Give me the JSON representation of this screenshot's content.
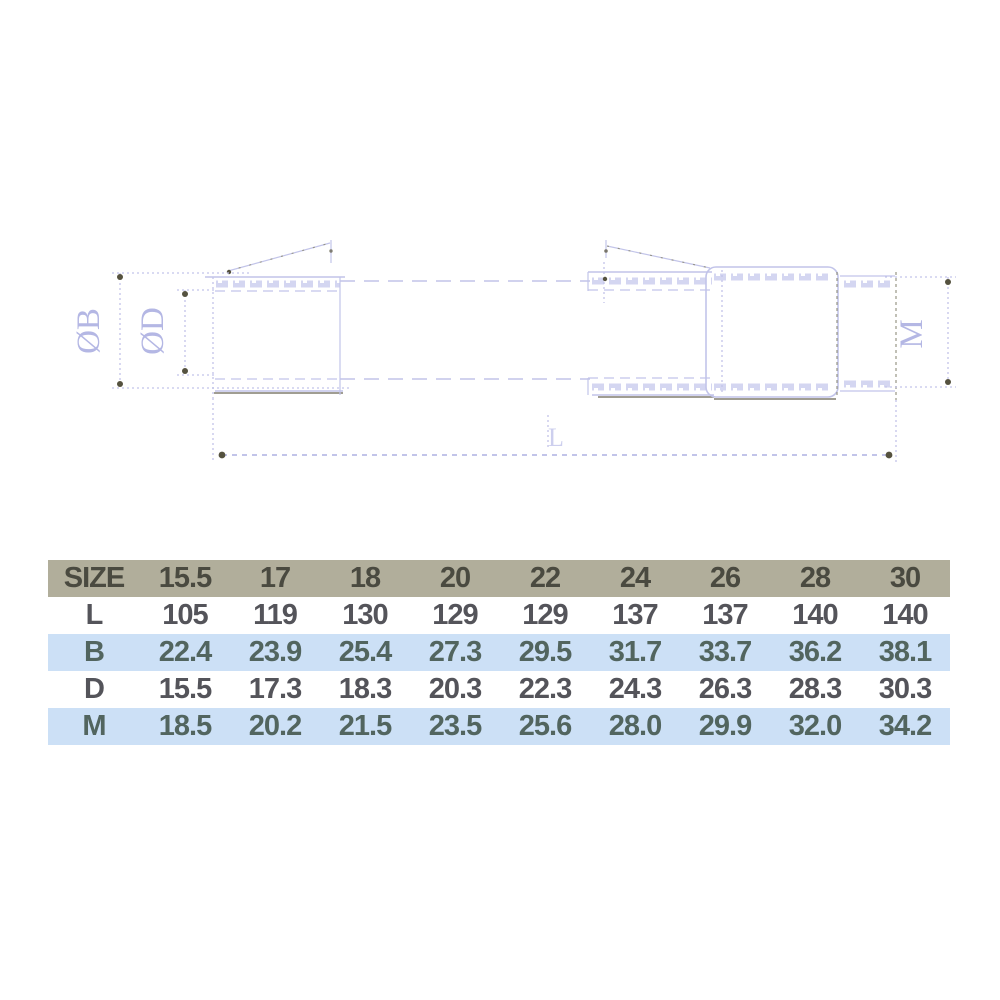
{
  "drawing": {
    "labels": {
      "diameter_b": "ØB",
      "diameter_d": "ØD",
      "length": "L",
      "thread": "M"
    },
    "colors": {
      "line": "#c2c4e9",
      "line_soft": "#cdcfee",
      "label": "#b4b7e4",
      "accent_dark": "#55523f",
      "accent_mid": "#8f8d7c"
    }
  },
  "table": {
    "colors": {
      "header_bg": "#b1ae9b",
      "stripe_bg": "#cce0f6",
      "plain_bg": "#ffffff",
      "header_text": "#4a4a40",
      "plain_text": "#54545a",
      "stripe_text": "#52655f"
    },
    "columns": [
      "SIZE",
      "15.5",
      "17",
      "18",
      "20",
      "22",
      "24",
      "26",
      "28",
      "30"
    ],
    "rows": [
      {
        "label": "L",
        "striped": false,
        "values": [
          "105",
          "119",
          "130",
          "129",
          "129",
          "137",
          "137",
          "140",
          "140"
        ]
      },
      {
        "label": "B",
        "striped": true,
        "values": [
          "22.4",
          "23.9",
          "25.4",
          "27.3",
          "29.5",
          "31.7",
          "33.7",
          "36.2",
          "38.1"
        ]
      },
      {
        "label": "D",
        "striped": false,
        "values": [
          "15.5",
          "17.3",
          "18.3",
          "20.3",
          "22.3",
          "24.3",
          "26.3",
          "28.3",
          "30.3"
        ]
      },
      {
        "label": "M",
        "striped": true,
        "values": [
          "18.5",
          "20.2",
          "21.5",
          "23.5",
          "25.6",
          "28.0",
          "29.9",
          "32.0",
          "34.2"
        ]
      }
    ]
  }
}
